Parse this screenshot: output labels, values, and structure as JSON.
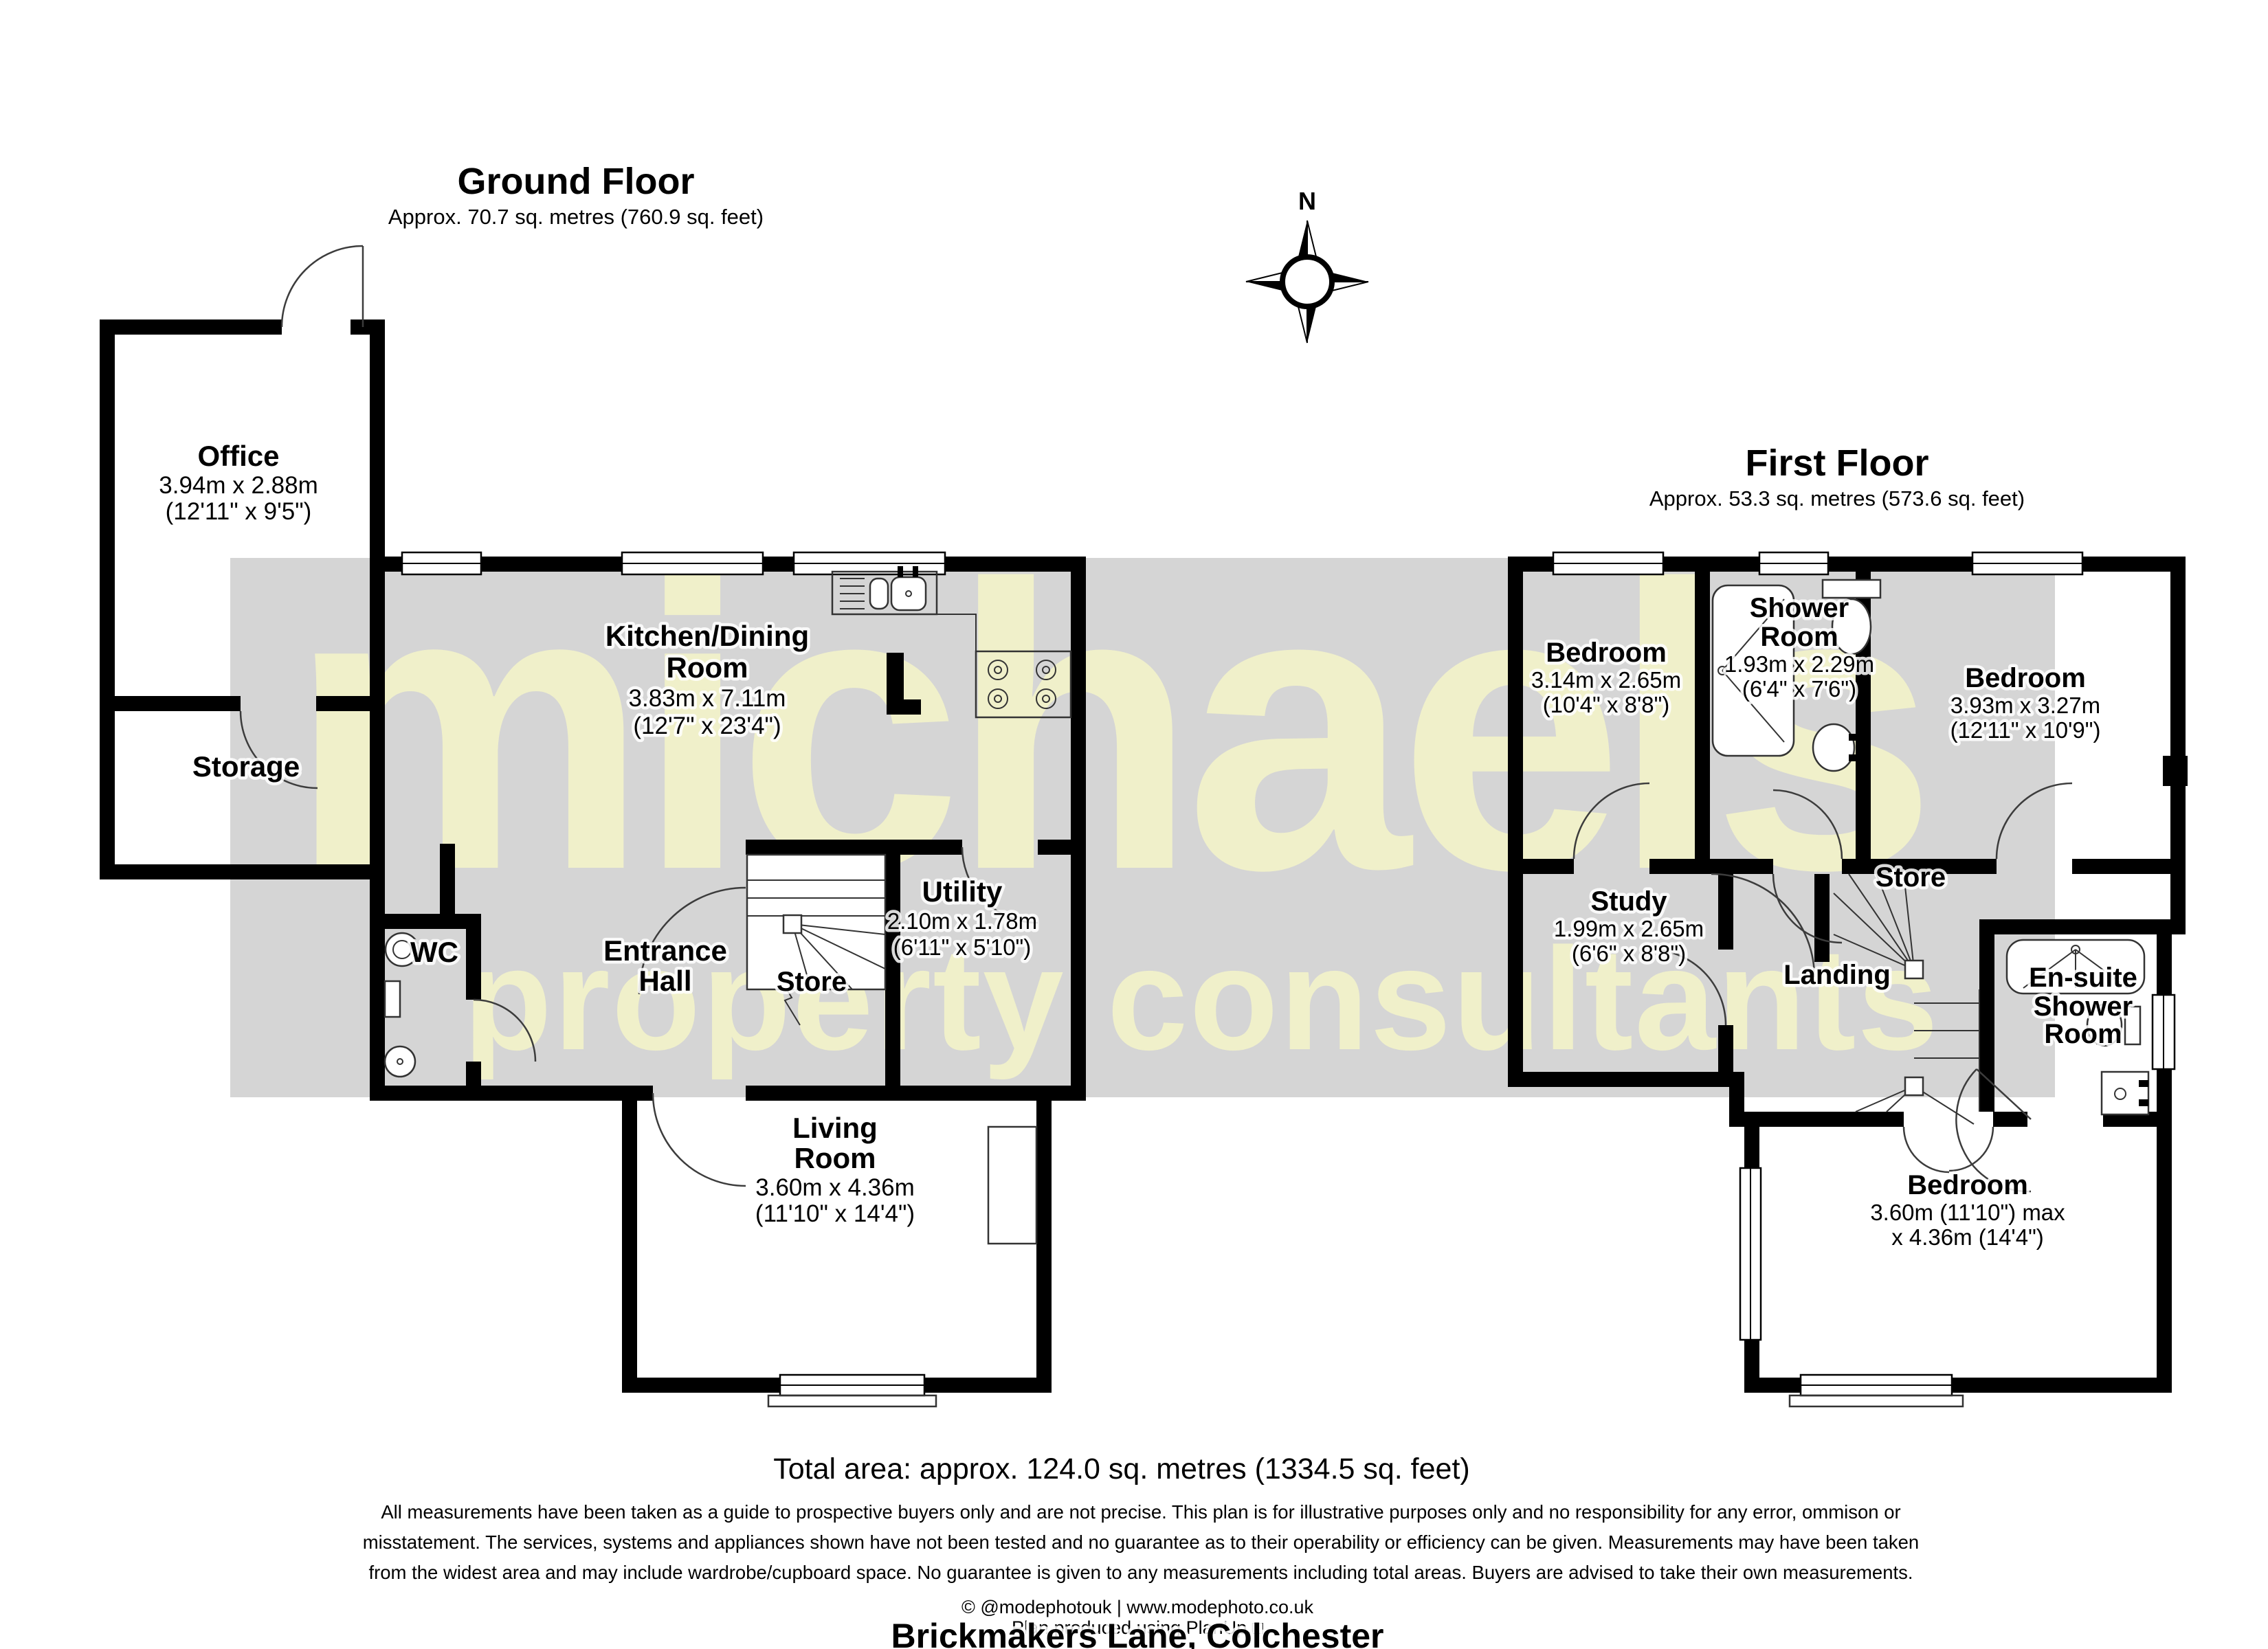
{
  "address": "Brickmakers Lane, Colchester",
  "compass": {
    "north_label": "N"
  },
  "watermark": {
    "line1": "michaels",
    "line2": "property consultants"
  },
  "summary": {
    "total_area": "Total area: approx. 124.0 sq. metres (1334.5 sq. feet)"
  },
  "disclaimer": {
    "line1": "All measurements have been taken as a guide to prospective buyers only and are not precise. This plan is for illustrative purposes only and no responsibility for any error, ommison or",
    "line2": "misstatement. The services, systems and appliances shown have not been tested and no guarantee as to their operability or efficiency can be given. Measurements may have been taken",
    "line3": "from the widest area and may include wardrobe/cupboard space. No guarantee is given to any measurements including total areas. Buyers are advised to take their own measurements."
  },
  "footer": {
    "credit": "© @modephotouk | www.modephoto.co.uk",
    "produced": "Plan produced using PlanUp.□"
  },
  "ground_floor": {
    "title": "Ground Floor",
    "subtitle": "Approx. 70.7 sq. metres (760.9 sq. feet)",
    "office": {
      "name": "Office",
      "metric": "3.94m x 2.88m",
      "imperial": "(12'11\" x 9'5\")"
    },
    "storage": {
      "name": "Storage"
    },
    "kitchen": {
      "name1": "Kitchen/Dining",
      "name2": "Room",
      "metric": "3.83m x 7.11m",
      "imperial": "(12'7\" x 23'4\")"
    },
    "wc": {
      "name": "WC"
    },
    "hall": {
      "name1": "Entrance",
      "name2": "Hall"
    },
    "store": {
      "name": "Store"
    },
    "utility": {
      "name": "Utility",
      "metric": "2.10m x 1.78m",
      "imperial": "(6'11\" x 5'10\")"
    },
    "living": {
      "name1": "Living",
      "name2": "Room",
      "metric": "3.60m x 4.36m",
      "imperial": "(11'10\" x 14'4\")"
    }
  },
  "first_floor": {
    "title": "First Floor",
    "subtitle": "Approx. 53.3 sq. metres (573.6 sq. feet)",
    "bedroom1": {
      "name": "Bedroom",
      "metric": "3.14m x 2.65m",
      "imperial": "(10'4\" x 8'8\")"
    },
    "shower": {
      "name1": "Shower",
      "name2": "Room",
      "metric": "1.93m x 2.29m",
      "imperial": "(6'4\" x 7'6\")"
    },
    "bedroom2": {
      "name": "Bedroom",
      "metric": "3.93m x 3.27m",
      "imperial": "(12'11\" x 10'9\")"
    },
    "study": {
      "name": "Study",
      "metric": "1.99m x 2.65m",
      "imperial": "(6'6\" x 8'8\")"
    },
    "store": {
      "name": "Store"
    },
    "landing": {
      "name": "Landing"
    },
    "ensuite": {
      "name1": "En-suite",
      "name2": "Shower",
      "name3": "Room"
    },
    "bedroom3": {
      "name": "Bedroom",
      "metric": "3.60m (11'10\") max",
      "imperial": "x 4.36m (14'4\")"
    }
  }
}
